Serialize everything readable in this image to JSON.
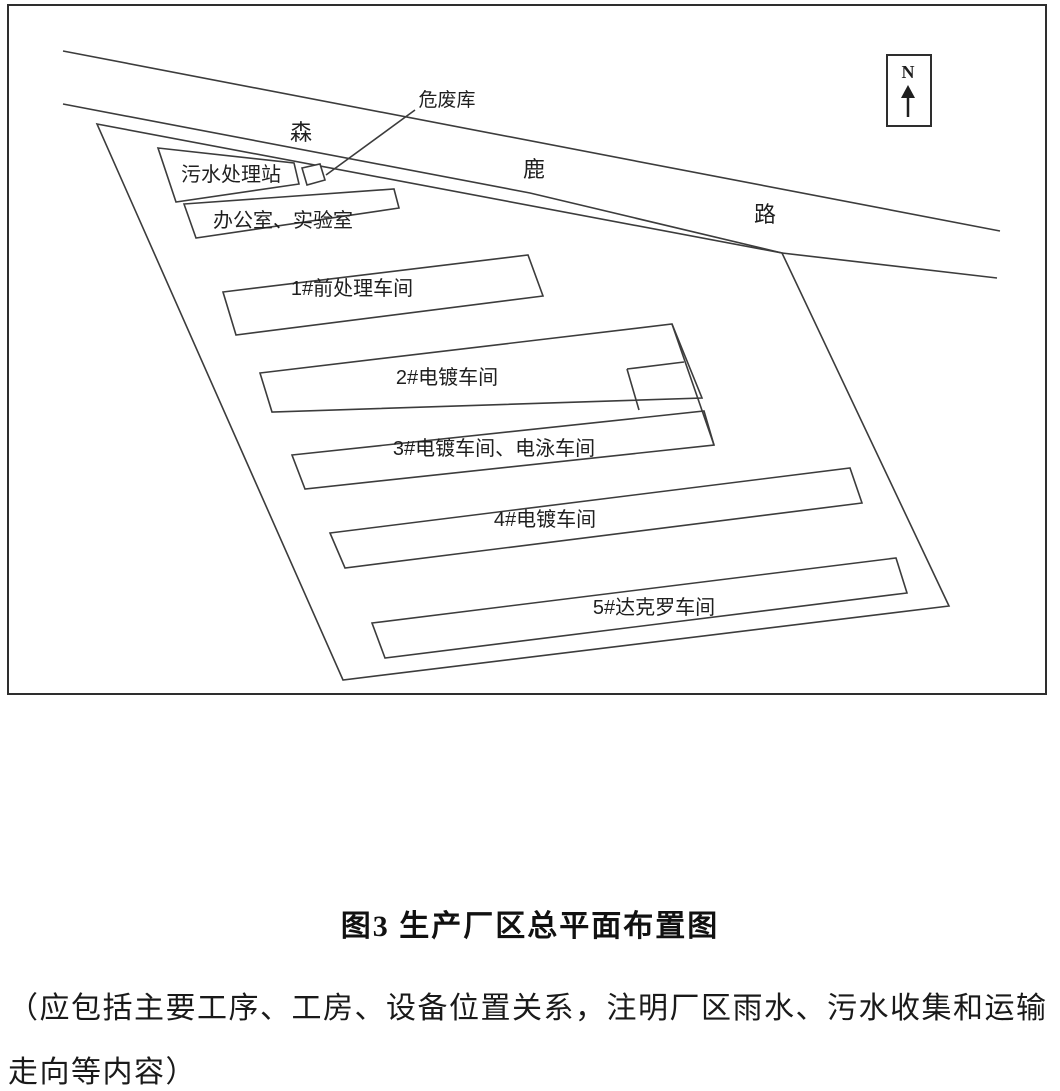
{
  "figure": {
    "caption": "图3  生产厂区总平面布置图",
    "note_line1": "（应包括主要工序、工房、设备位置关系，注明厂区雨水、污水收集和运输",
    "note_line2": "走向等内容）"
  },
  "compass": {
    "label": "N"
  },
  "road": {
    "char1": "森",
    "char2": "鹿",
    "char3": "路"
  },
  "labels": {
    "hazardous_waste": "危废库",
    "sewage_station": "污水处理站",
    "office_lab": "办公室、实验室",
    "workshop1": "1#前处理车间",
    "workshop2": "2#电镀车间",
    "workshop3": "3#电镀车间、电泳车间",
    "workshop4": "4#电镀车间",
    "workshop5": "5#达克罗车间"
  },
  "colors": {
    "line": "#3c3c3c",
    "text": "#1f1f1f",
    "background": "#ffffff"
  }
}
